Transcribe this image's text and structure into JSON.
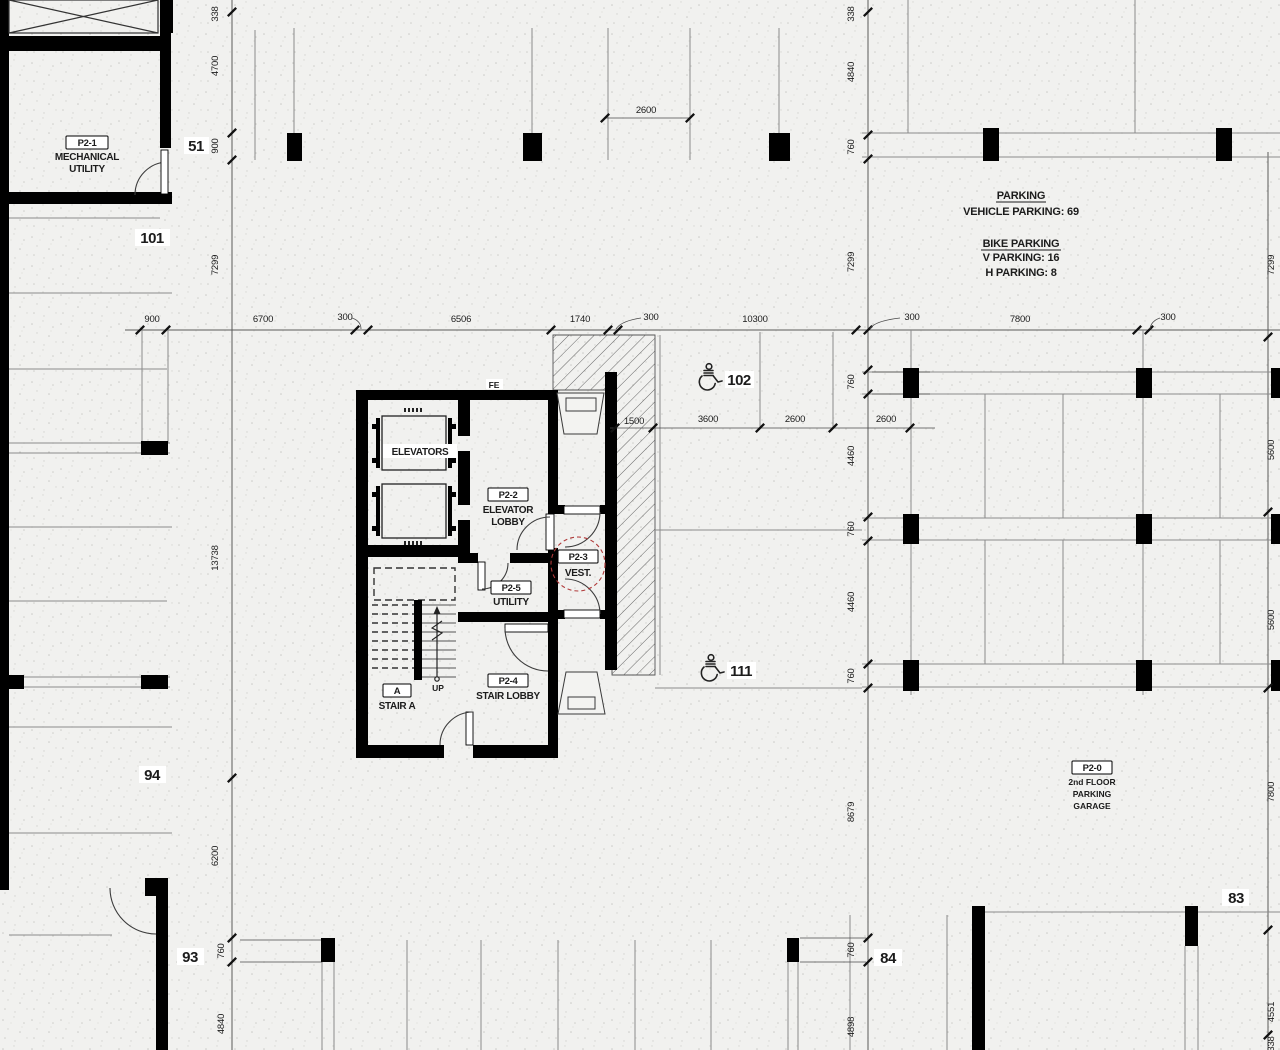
{
  "rooms": {
    "mech": {
      "tag": "P2-1",
      "line1": "MECHANICAL",
      "line2": "UTILITY"
    },
    "lobby": {
      "tag": "P2-2",
      "line1": "ELEVATOR",
      "line2": "LOBBY"
    },
    "vest": {
      "tag": "P2-3",
      "line1": "VEST."
    },
    "stairlobby": {
      "tag": "P2-4",
      "line1": "STAIR LOBBY"
    },
    "utility": {
      "tag": "P2-5",
      "line1": "UTILITY"
    },
    "garage": {
      "tag": "P2-0",
      "line1": "2nd FLOOR",
      "line2": "PARKING",
      "line3": "GARAGE"
    },
    "stair": {
      "tag": "A",
      "line1": "STAIR A"
    },
    "elevators_label": "ELEVATORS",
    "fe_label": "FE",
    "up_label": "UP"
  },
  "parking_summary": {
    "title": "PARKING",
    "vehicle": "VEHICLE PARKING: 69",
    "bike_title": "BIKE PARKING",
    "v": "V PARKING: 16",
    "h": "H PARKING: 8"
  },
  "spaces": {
    "s51": "51",
    "s101": "101",
    "s94": "94",
    "s93": "93",
    "s84": "84",
    "s83": "83",
    "s102": "102",
    "s111": "111"
  },
  "dims": {
    "top_stall": "2600",
    "main_row": [
      "900",
      "6700",
      "300",
      "6506",
      "1740",
      "300",
      "10300",
      "300",
      "7800",
      "300"
    ],
    "stall_row": [
      "1500",
      "3600",
      "2600",
      "2600"
    ],
    "left_chain": [
      "338",
      "4700",
      "900",
      "7299",
      "13738",
      "6200",
      "760",
      "4840"
    ],
    "mid_chain": [
      "338",
      "4840",
      "760",
      "7299",
      "760",
      "4460",
      "760",
      "4460",
      "760",
      "8679",
      "760",
      "4898"
    ],
    "right_chain": [
      "7299",
      "5600",
      "5600",
      "7800",
      "4551",
      "338"
    ]
  },
  "colors": {
    "wall": "#000000",
    "stall_line": "#8b8b8b",
    "dim_text": "#1c1c1c",
    "vest_circle_red": "#b03a3a",
    "paper": "#f1f1ef"
  }
}
